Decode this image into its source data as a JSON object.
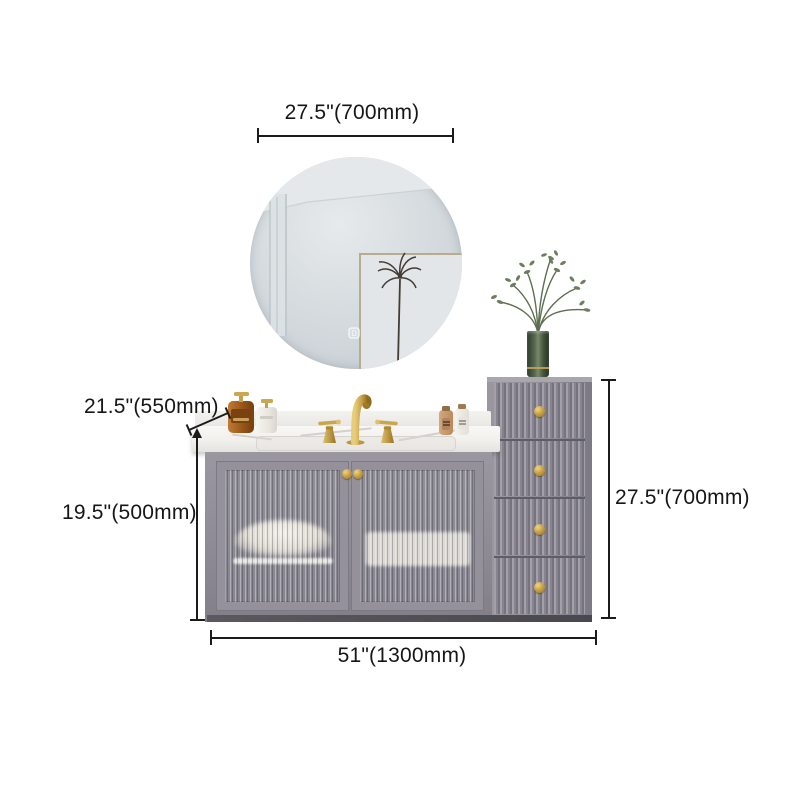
{
  "annotations": {
    "mirror_width": "27.5\"(700mm)",
    "counter_depth": "21.5\"(550mm)",
    "vanity_height": "19.5\"(500mm)",
    "side_cabinet_height": "27.5\"(700mm)",
    "total_width": "51\"(1300mm)"
  },
  "product": {
    "scene": "wall-mounted grey bathroom vanity set with round mirror, marble top, gold faucet, two reeded-glass doors and four-drawer fluted side cabinet with plant vase"
  },
  "colors": {
    "background": "#ffffff",
    "dimension_ink": "#1b1b1b",
    "cabinet_gray": "#8f8c95",
    "brass_gold": "#c9a24a",
    "marble_white": "#f5f3f0",
    "mirror_glass": "#d5dade",
    "vase_green": "#44523f",
    "foliage_green": "#6d7e5d",
    "amber_glass": "#a9631f"
  }
}
